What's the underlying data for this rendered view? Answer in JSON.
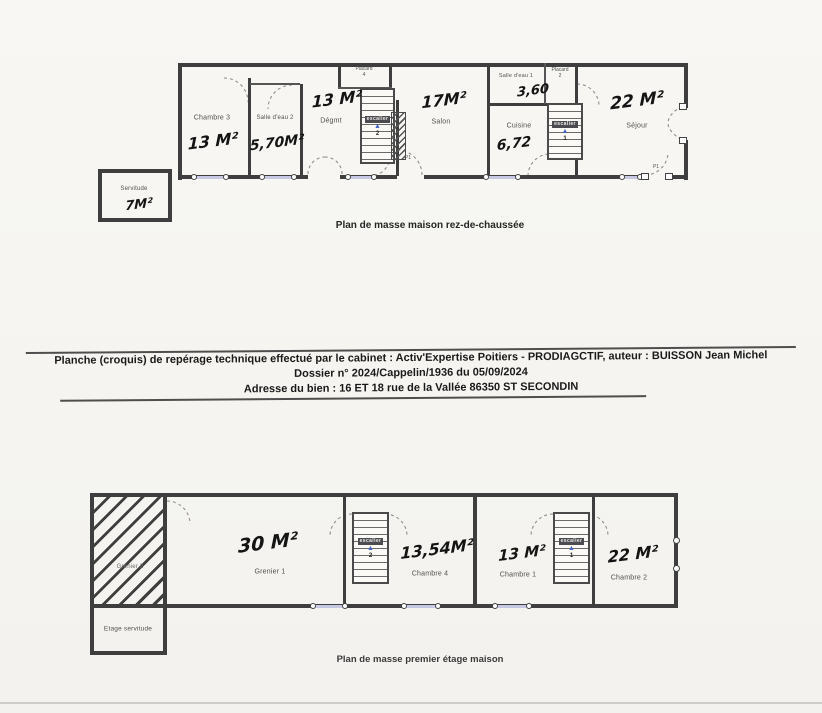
{
  "report": {
    "line1": "Planche (croquis) de repérage technique effectué par le cabinet : Activ'Expertise Poitiers - PRODIAGCTIF, auteur : BUISSON Jean Michel",
    "line2": "Dossier n° 2024/Cappelin/1936 du 05/09/2024",
    "line3": "Adresse du bien : 16 ET 18 rue de la Vallée  86350 ST SECONDIN"
  },
  "icons": {
    "stair_arrow": "▲"
  },
  "rdc": {
    "caption": "Plan de masse maison rez-de-chaussée",
    "chambre3": {
      "name": "Chambre 3",
      "area": "13 M²"
    },
    "salle_eau2": {
      "name": "Salle d'eau 2",
      "area": "5,70M²"
    },
    "degmt": {
      "name": "Dégmt",
      "area": "13 M²"
    },
    "placard4": {
      "name": "Placard",
      "num": "4"
    },
    "escalier2": {
      "name": "escalier",
      "num": "2"
    },
    "salon": {
      "name": "Salon",
      "area": "17M²"
    },
    "salle_eau1": {
      "name": "Salle d'eau 1",
      "area": "3,60"
    },
    "placard2": {
      "name": "Placard",
      "num": "2"
    },
    "escalier1": {
      "name": "escalier",
      "num": "1"
    },
    "cuisine": {
      "name": "Cuisine",
      "area": "6,72"
    },
    "sejour": {
      "name": "Séjour",
      "area": "22 M²"
    },
    "servitude": {
      "name": "Servitude",
      "area": "7M²"
    },
    "door_p1_salon": "P1",
    "door_p1_sejour": "P1"
  },
  "etage": {
    "caption": "Plan de masse premier étage maison",
    "grenier2": {
      "name": "Grenier 2"
    },
    "grenier1": {
      "name": "Grenier 1",
      "area": "30 M²"
    },
    "chambre4": {
      "name": "Chambre 4",
      "area": "13,54M²"
    },
    "chambre1": {
      "name": "Chambre 1",
      "area": "13 M²"
    },
    "chambre2": {
      "name": "Chambre 2",
      "area": "22 M²"
    },
    "etage_servitude": {
      "name": "Etage servitude"
    },
    "escalier_g": {
      "name": "escalier",
      "num": "2"
    },
    "escalier_d": {
      "name": "escalier",
      "num": "1"
    }
  }
}
